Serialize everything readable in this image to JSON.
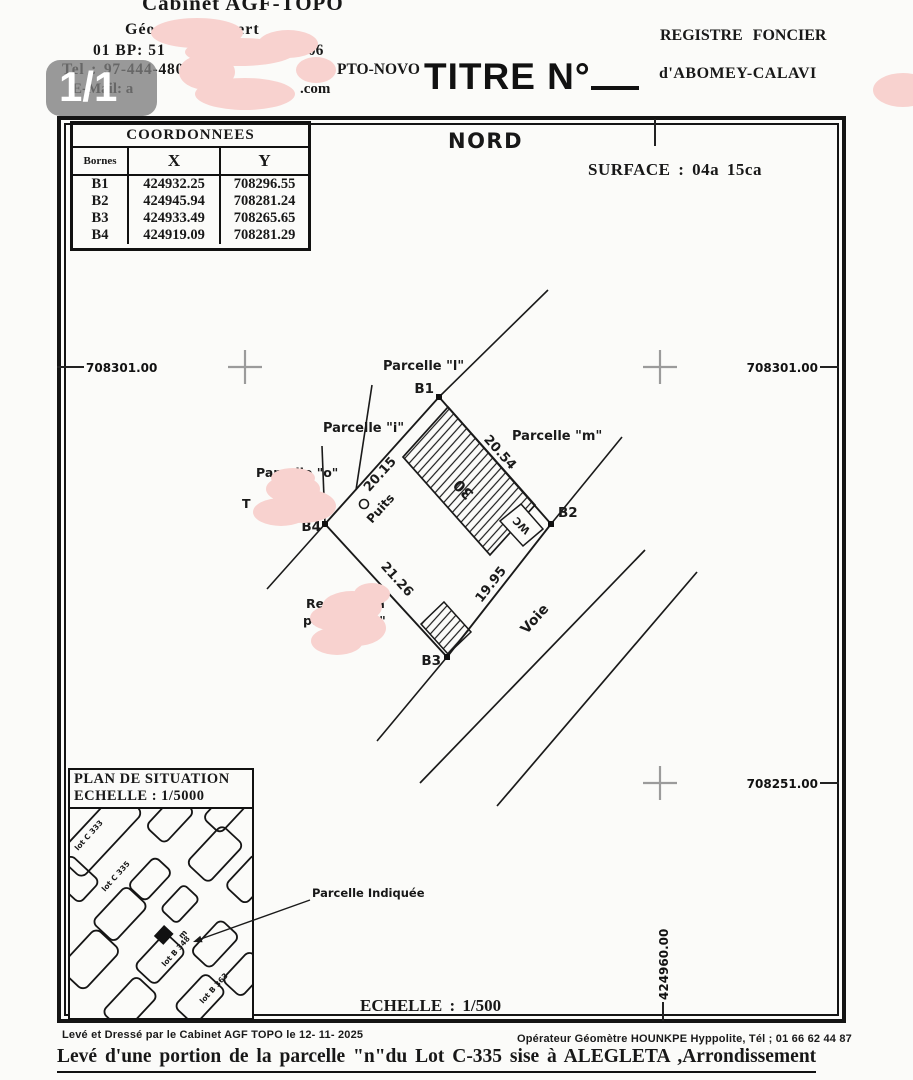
{
  "viewer": {
    "page_indicator": "1/1"
  },
  "colors": {
    "ink": "#1a1a1a",
    "redaction_pink": "#f8d2cf",
    "badge_gray": "#7d7d7d",
    "grid_cross_gray": "#9b9b9b",
    "paper": "#fbfbf9"
  },
  "header": {
    "cabinet_line1": "Cabinet AGF-TOPO",
    "cabinet_line2": "Géomètre-Expert",
    "bp_left": "01 BP: 51",
    "bp_right": "-006",
    "tel_line": "Tel : 97-444-480 94-44",
    "tel_city": "PTO-NOVO",
    "email_left": "E-Mail: a",
    "email_right": ".com",
    "titre": "TITRE N°",
    "registre_line1": "REGISTRE FONCIER",
    "registre_line2": "d'ABOMEY-CALAVI"
  },
  "frame": {
    "nord": "NORD",
    "surface": "SURFACE : 04a 15ca",
    "coords_table": {
      "title": "COORDONNEES",
      "headers": [
        "Bornes",
        "X",
        "Y"
      ],
      "rows": [
        [
          "B1",
          "424932.25",
          "708296.55"
        ],
        [
          "B2",
          "424945.94",
          "708281.24"
        ],
        [
          "B3",
          "424933.49",
          "708265.65"
        ],
        [
          "B4",
          "424919.09",
          "708281.29"
        ]
      ]
    },
    "grid_labels": {
      "left_north": "708301.00",
      "right_north": "708301.00",
      "right_south": "708251.00",
      "bottom_east": "424960.00"
    },
    "plot": {
      "corner_b1": "B1",
      "corner_b2": "B2",
      "corner_b3": "B3",
      "corner_b4": "B4",
      "dim_b4_b1": "20.15",
      "dim_b1_b2": "20.54",
      "dim_b4_b3": "21.26",
      "dim_b3_b2": "19.95",
      "parcelle_l": "Parcelle \"l\"",
      "parcelle_i": "Parcelle \"i\"",
      "parcelle_m": "Parcelle \"m\"",
      "parcelle_o": "Parcelle \"o\"",
      "fragment_t": "T",
      "reste_line1": "Reste de la",
      "reste_line2": "parcelle \"n\"",
      "puits": "Puits",
      "wc": "WC",
      "building_number": "30",
      "voie": "Voie"
    },
    "inset": {
      "title_line1": "PLAN DE SITUATION",
      "title_line2": "ECHELLE : 1/5000",
      "lot_label_1": "lot C 333",
      "lot_label_2": "lot C 335",
      "lot_label_3": "lot B 348",
      "lot_label_4": "lot B 363",
      "marker_letter": "m",
      "callout": "Parcelle Indiquée"
    },
    "echelle": "ECHELLE : 1/500"
  },
  "footer": {
    "left": "Levé et Dressé par le Cabinet AGF TOPO  le 12- 11- 2025",
    "right": "Opérateur Géomètre HOUNKPE Hyppolite, Tél ; 01 66 62 44 87",
    "title": "Levé d'une portion de la parcelle \"n\"du Lot C-335 sise à ALEGLETA ,Arrondissement"
  }
}
